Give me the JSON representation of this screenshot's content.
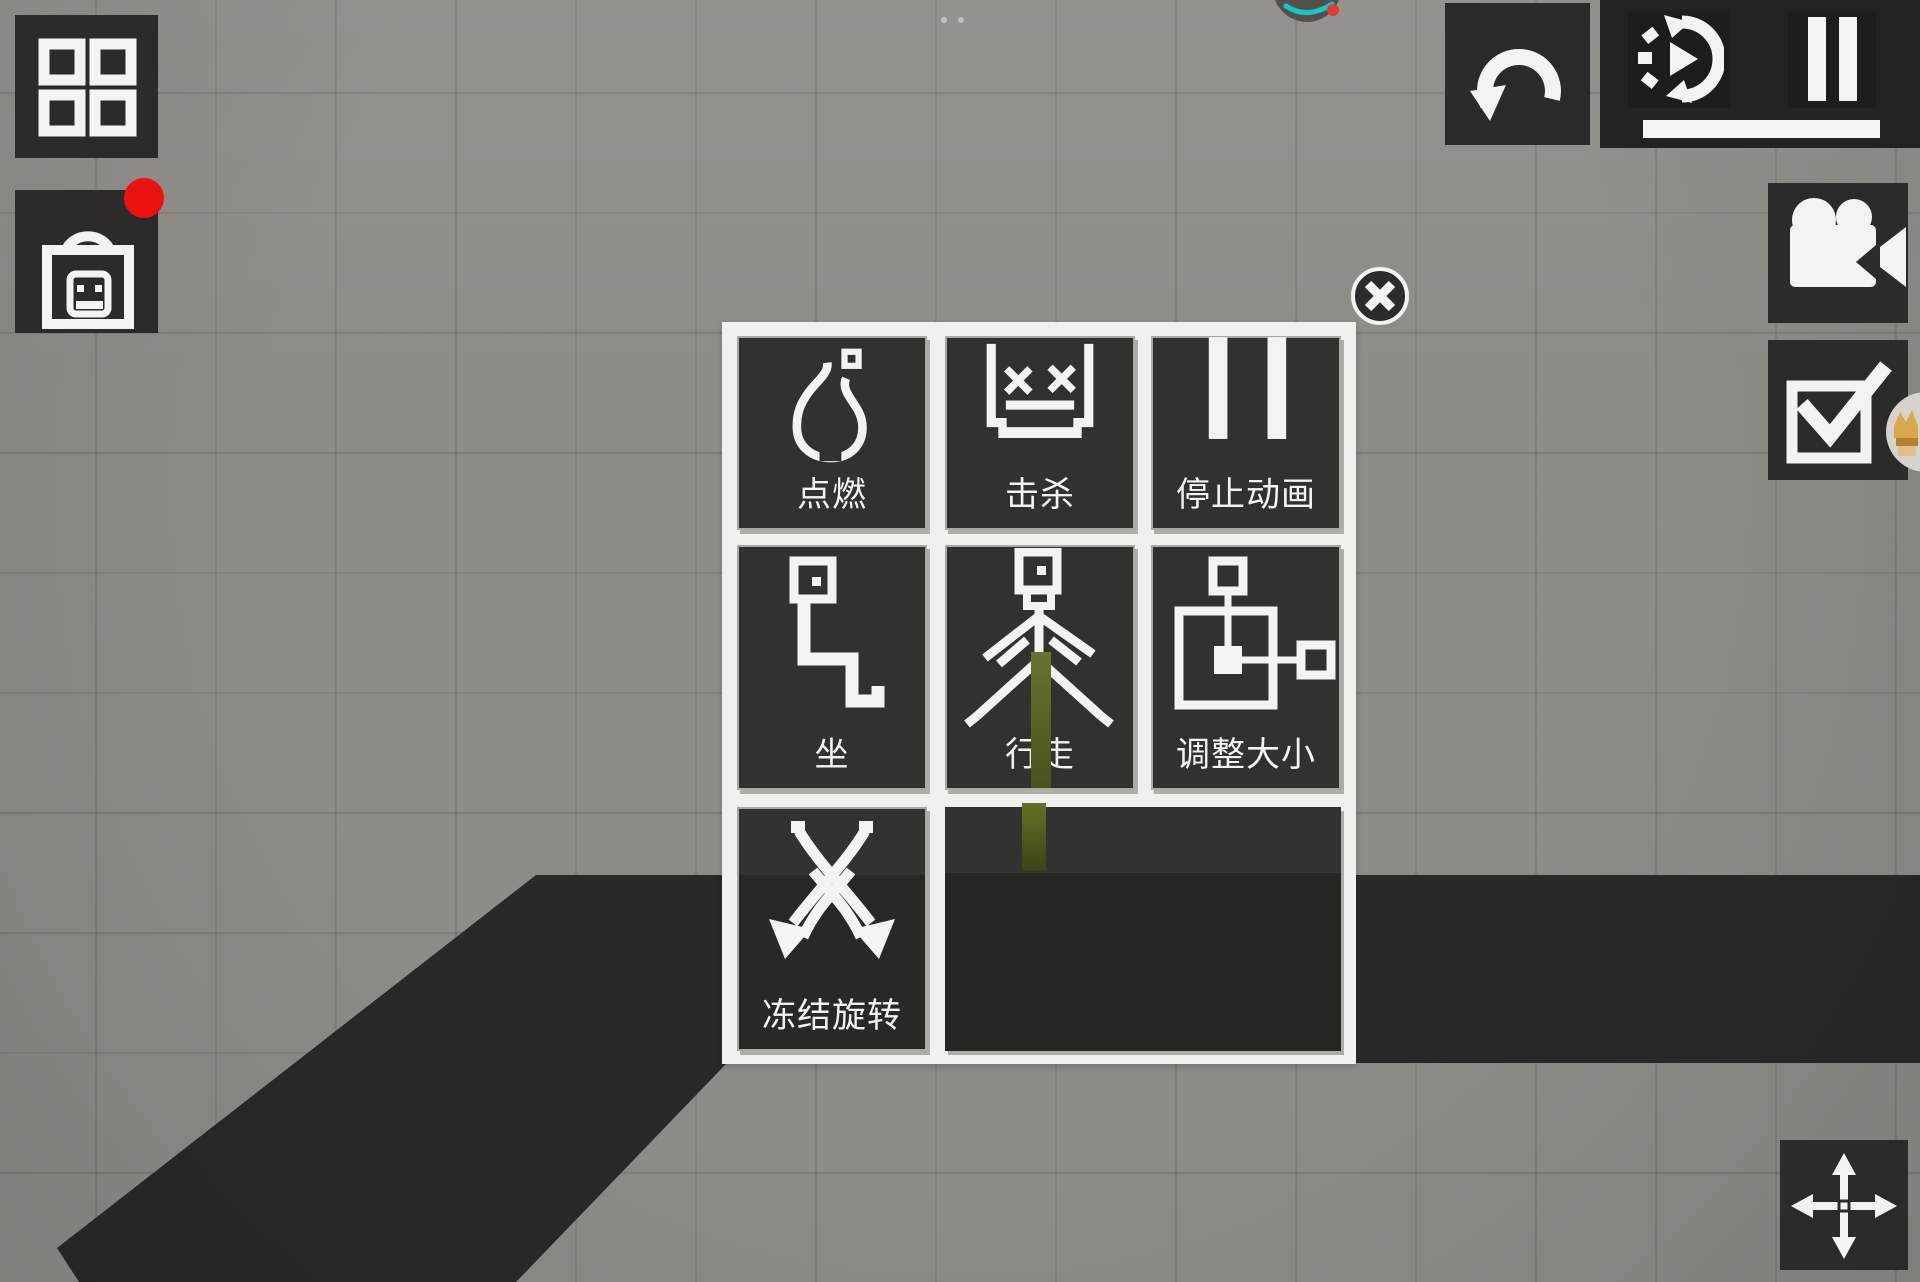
{
  "colors": {
    "background": "#8f8c88",
    "grid_line": "rgba(58,51,45,0.17)",
    "button_dark": "#2d2b29",
    "panel_dark": "#242221",
    "cell_dark": "#33312e",
    "popup_bg": "#f2f0ed",
    "icon_white": "#f5f3f1",
    "ground_dark": "#2b2927",
    "notification_red": "#ee1111",
    "teal_accent": "#17c6c9",
    "character_green": "#636c26",
    "trophy_gold": "#d7a84c"
  },
  "hud": {
    "top_left": {
      "grid_button": {
        "icon": "grid-icon"
      },
      "inventory_button": {
        "icon": "shopping-bag-icon",
        "badge": "red-notification-dot"
      }
    },
    "top_right": {
      "undo_button": {
        "icon": "undo-icon"
      },
      "time_speed_button": {
        "icon": "time-speed-icon"
      },
      "pause_button": {
        "icon": "pause-icon"
      },
      "time_slider": {
        "value_percent": 100
      }
    },
    "right_side": {
      "camera_button": {
        "icon": "video-camera-icon"
      },
      "confirm_button": {
        "icon": "checkbox-icon"
      }
    },
    "bottom_right": {
      "move_button": {
        "icon": "move-arrows-icon"
      }
    }
  },
  "popup": {
    "close_button": {
      "icon": "close-icon"
    },
    "items": [
      {
        "label": "点燃",
        "icon": "flame-icon"
      },
      {
        "label": "击杀",
        "icon": "dead-face-icon"
      },
      {
        "label": "停止动画",
        "icon": "pause-bars-icon"
      },
      {
        "label": "坐",
        "icon": "sit-figure-icon"
      },
      {
        "label": "行走",
        "icon": "walk-figure-icon"
      },
      {
        "label": "调整大小",
        "icon": "resize-icon"
      },
      {
        "label": "冻结旋转",
        "icon": "crossed-swords-icon"
      }
    ]
  }
}
